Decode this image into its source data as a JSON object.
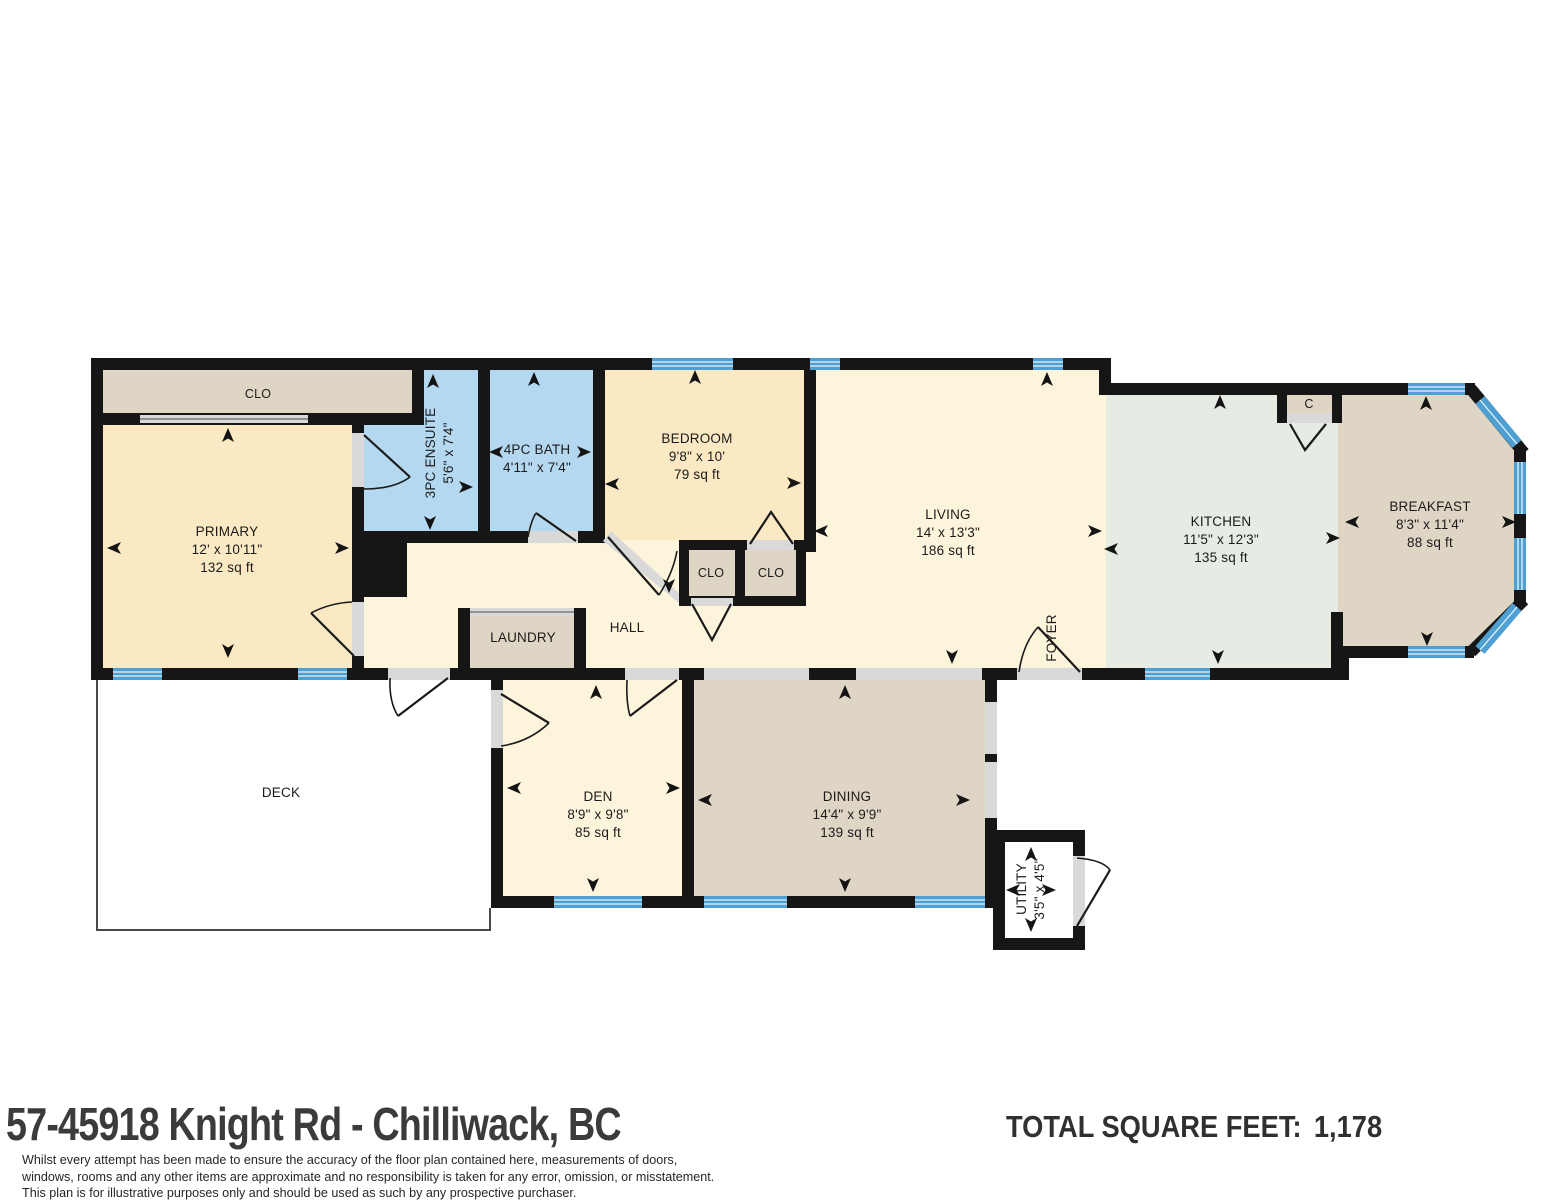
{
  "plan": {
    "rooms": {
      "clo_primary": {
        "name": "CLO"
      },
      "primary": {
        "name": "PRIMARY",
        "dims": "12' x 10'11\"",
        "area": "132 sq ft"
      },
      "ensuite": {
        "name": "3PC ENSUITE",
        "dims": "5'6\" x 7'4\""
      },
      "bath": {
        "name": "4PC BATH",
        "dims": "4'11\" x 7'4\""
      },
      "bedroom": {
        "name": "BEDROOM",
        "dims": "9'8\" x 10'",
        "area": "79 sq ft"
      },
      "clo_hall_left": {
        "name": "CLO"
      },
      "clo_hall_right": {
        "name": "CLO"
      },
      "living": {
        "name": "LIVING",
        "dims": "14' x 13'3\"",
        "area": "186 sq ft"
      },
      "kitchen": {
        "name": "KITCHEN",
        "dims": "11'5\" x 12'3\"",
        "area": "135 sq ft"
      },
      "breakfast": {
        "name": "BREAKFAST",
        "dims": "8'3\" x 11'4\"",
        "area": "88 sq ft"
      },
      "c_closet": {
        "name": "C"
      },
      "hall": {
        "name": "HALL"
      },
      "laundry": {
        "name": "LAUNDRY"
      },
      "foyer": {
        "name": "FOYER"
      },
      "deck": {
        "name": "DECK"
      },
      "den": {
        "name": "DEN",
        "dims": "8'9\" x 9'8\"",
        "area": "85 sq ft"
      },
      "dining": {
        "name": "DINING",
        "dims": "14'4\" x 9'9\"",
        "area": "139 sq ft"
      },
      "utility": {
        "name": "UTILITY",
        "dims": "3'5\" x 4'5\""
      }
    },
    "colors": {
      "wall": "#161616",
      "window": "#4e9fd2",
      "bedroom_fill": "#fbe9c4",
      "living_fill": "#fdf4dc",
      "bath_fill": "#b5d8f1",
      "closet_fill": "#ded5c4",
      "kitchen_fill": "#e6ebe3",
      "door_opening": "#d9d9d9"
    }
  },
  "footer": {
    "address": "57-45918 Knight Rd - Chilliwack, BC",
    "total_label": "TOTAL SQUARE FEET:",
    "total_value": "1,178",
    "disclaimer": [
      "Whilst every attempt has been made to ensure the accuracy of the floor plan contained here, measurements of doors,",
      "windows, rooms and any other items are approximate and no responsibility is taken for any error, omission, or misstatement.",
      "This plan is for illustrative purposes only and should be used as such by any prospective purchaser."
    ]
  }
}
